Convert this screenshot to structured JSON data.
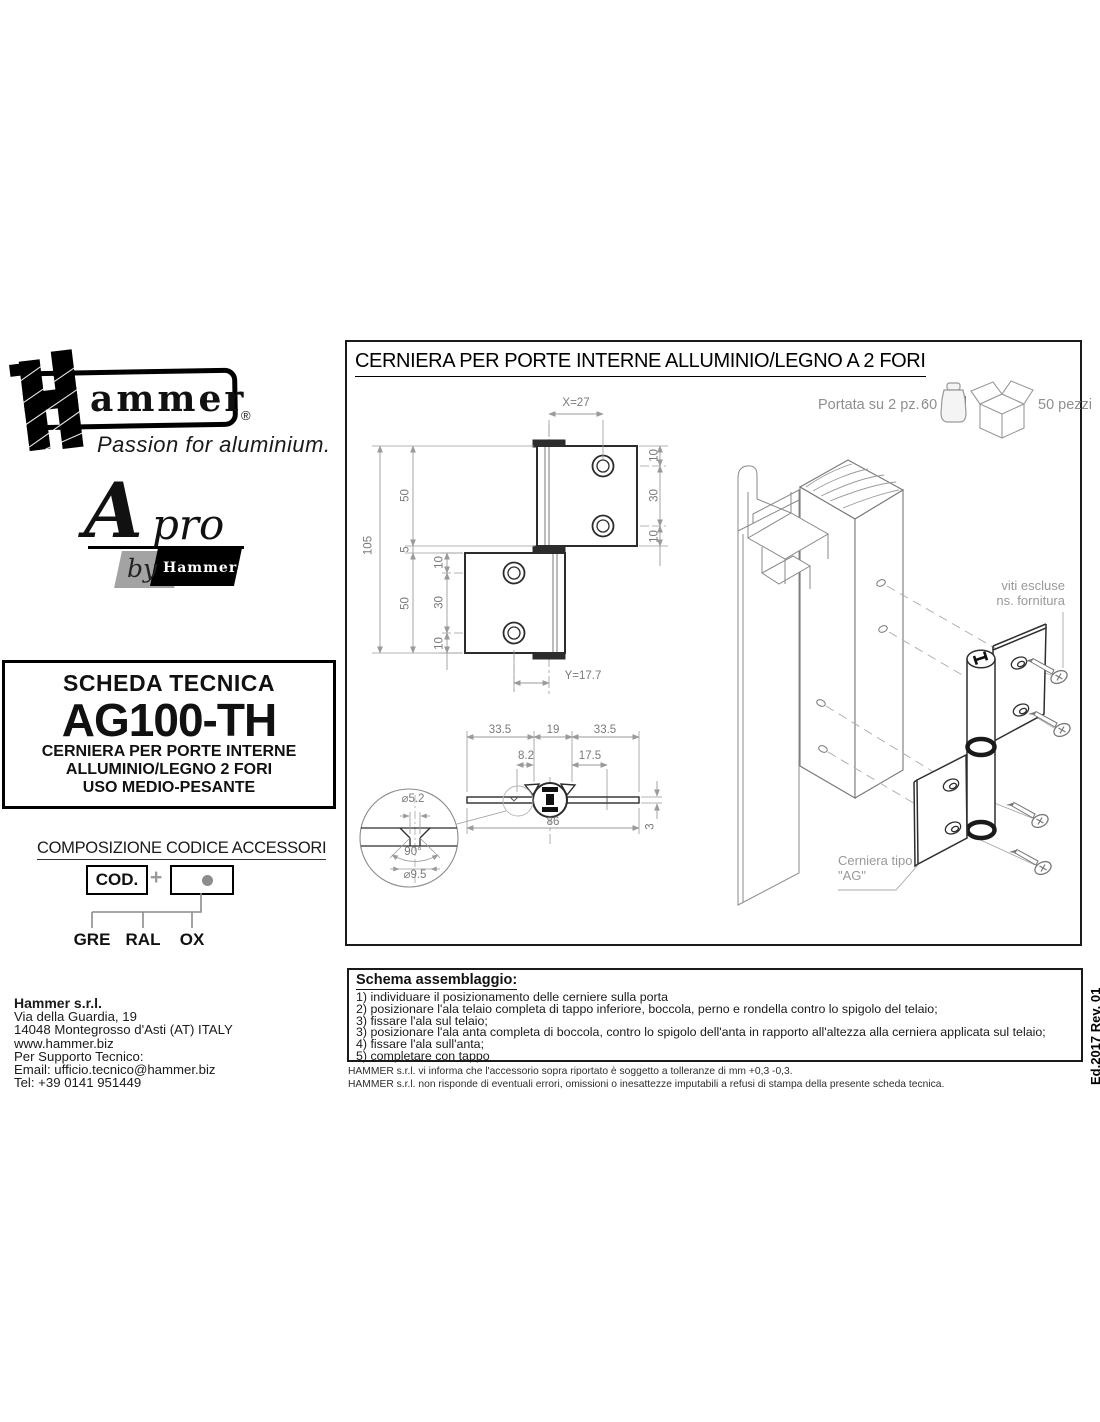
{
  "brand": {
    "name": "Hammer",
    "wordmark_rest": "ammer",
    "registered": "®",
    "tagline": "Passion for aluminium.",
    "apro_a": "A",
    "apro_pro": "pro",
    "apro_by": "by",
    "apro_hammer": "Hammer"
  },
  "datasheet": {
    "header": "SCHEDA TECNICA",
    "code": "AG100-TH",
    "description": [
      "CERNIERA PER PORTE INTERNE",
      "ALLUMINIO/LEGNO 2 FORI",
      "USO MEDIO-PESANTE"
    ]
  },
  "accessories": {
    "title": "COMPOSIZIONE CODICE ACCESSORI",
    "cod_label": "COD.",
    "plus": "+",
    "options": [
      "GRE",
      "RAL",
      "OX"
    ]
  },
  "company": {
    "name": "Hammer s.r.l.",
    "lines": [
      "Via della Guardia, 19",
      "14048 Montegrosso d'Asti (AT) ITALY",
      "www.hammer.biz",
      "Per Supporto Tecnico:",
      "Email: ufficio.tecnico@hammer.biz",
      "Tel: +39 0141 951449"
    ]
  },
  "drawing": {
    "title": "CERNIERA PER PORTE INTERNE ALLUMINIO/LEGNO A 2 FORI",
    "capacity_label": "Portata su 2 pz. :",
    "capacity_value": "60",
    "capacity_unit": "Kg",
    "package_qty": "50 pezzi",
    "screws_note": [
      "viti escluse",
      "ns. fornitura"
    ],
    "hinge_type_note": [
      "Cerniera tipo",
      "\"AG\""
    ],
    "front_dims": {
      "x": "X=27",
      "total_h": "105",
      "top_h": "50",
      "gap": "5",
      "bottom_h": "50",
      "bl_top": "10",
      "bl_span": "30",
      "bl_bottom": "10",
      "tl_top": "10",
      "tl_span": "30",
      "tl_bottom": "10",
      "y": "Y=17.7"
    },
    "section_dims": {
      "left_wing": "33.5",
      "knuckle": "19",
      "right_wing": "33.5",
      "off_left": "8.2",
      "off_right": "17.5",
      "total": "86",
      "thickness": "3",
      "hole_dia": "⌀5.2",
      "countersink_angle": "90°",
      "head_dia": "⌀9.5"
    }
  },
  "assembly": {
    "title": "Schema assemblaggio:",
    "steps": [
      "1) individuare il posizionamento delle cerniere sulla porta",
      "2) posizionare l'ala telaio completa di tappo inferiore, boccola, perno e rondella contro lo spigolo del telaio;",
      "3) fissare l'ala sul telaio;",
      "3) posizionare l'ala anta completa di boccola, contro lo spigolo dell'anta in rapporto all'altezza alla cerniera applicata sul telaio;",
      "4) fissare l'ala sull'anta;",
      "5) completare con tappo"
    ]
  },
  "footnotes": [
    "HAMMER s.r.l. vi informa che l'accessorio sopra riportato è soggetto a tolleranze di mm +0,3 -0,3.",
    "HAMMER s.r.l. non risponde di eventuali errori, omissioni o inesattezze imputabili a refusi di stampa della presente scheda tecnica."
  ],
  "edition": "Ed.2017 Rev. 01"
}
